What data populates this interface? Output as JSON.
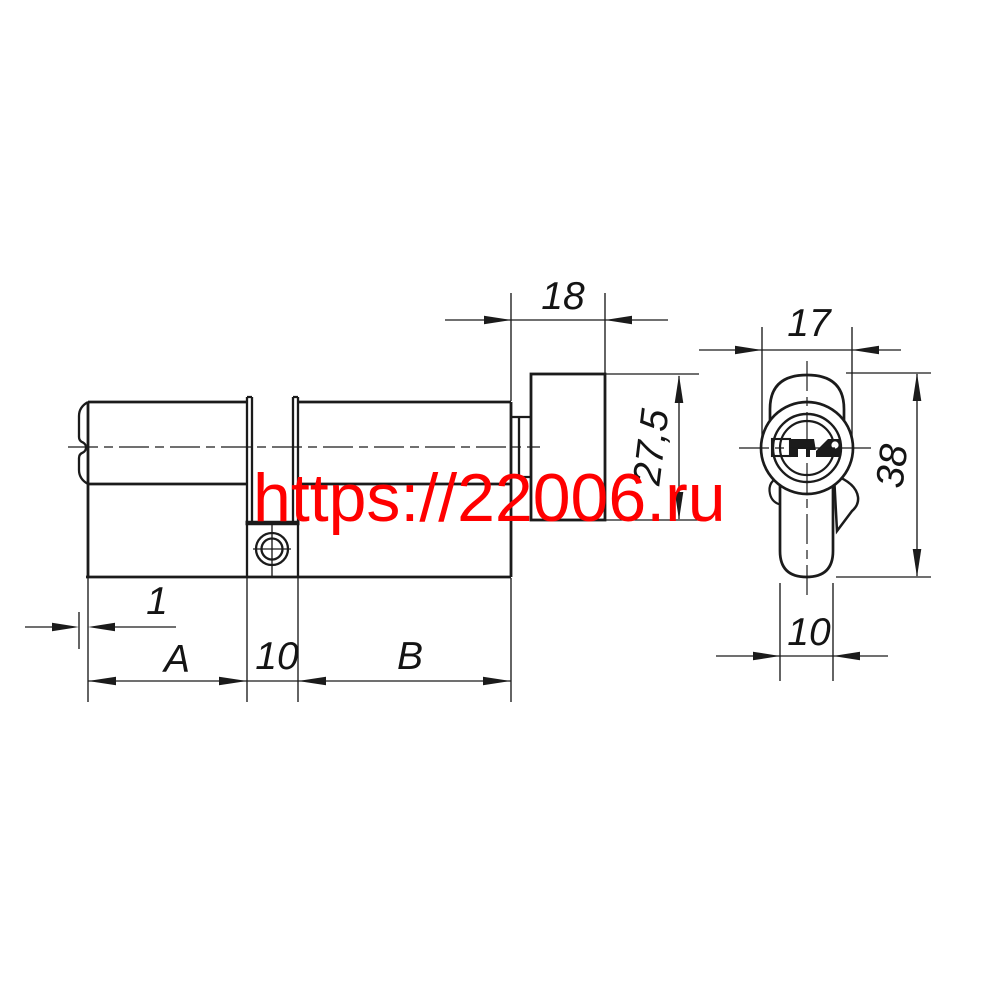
{
  "watermark": {
    "text": "https://22006.ru",
    "color": "#ff0000"
  },
  "drawing": {
    "line_color": "#1b1b1b",
    "background": "#ffffff"
  },
  "dimensions": {
    "knob_length": "18",
    "knob_height": "27,5",
    "plug_protrusion": "1",
    "half_a": "A",
    "cam_gap_width": "10",
    "half_b": "B",
    "body_diameter": "17",
    "total_height": "38",
    "body_width": "10"
  }
}
